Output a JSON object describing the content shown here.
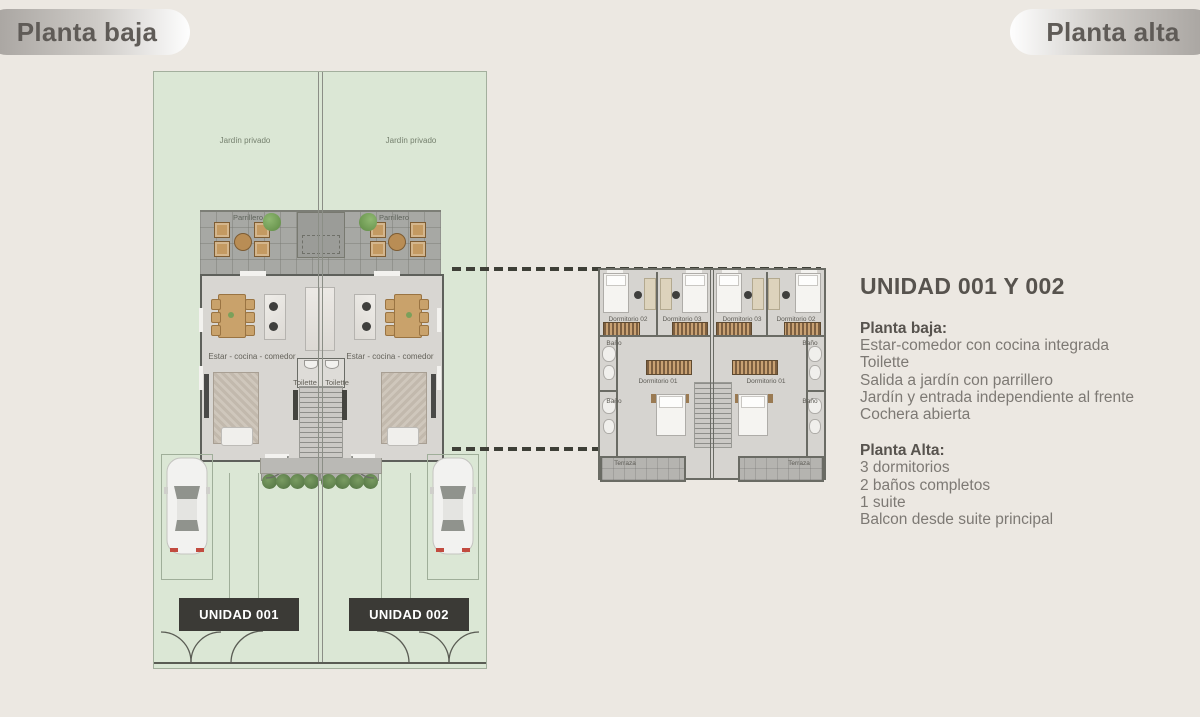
{
  "header": {
    "left_pill": "Planta baja",
    "right_pill": "Planta alta"
  },
  "ground_plan": {
    "garden_left_label": "Jardín privado",
    "garden_right_label": "Jardín privado",
    "parrillero_left_label": "Parrillero",
    "parrillero_right_label": "Parrillero",
    "living_left_label": "Estar - cocina - comedor",
    "living_right_label": "Estar - cocina - comedor",
    "toilette_left_label": "Toilette",
    "toilette_right_label": "Toilette",
    "unit_left_badge": "UNIDAD 001",
    "unit_right_badge": "UNIDAD 002"
  },
  "upper_plan": {
    "left_unit": {
      "bedroom2": "Dormitorio 02",
      "bedroom3": "Dormitorio 03",
      "bath_top": "Baño",
      "bedroom1": "Dormitorio 01",
      "bath_bottom": "Baño",
      "terrace": "Terraza"
    },
    "right_unit": {
      "bedroom3": "Dormitorio 03",
      "bedroom2": "Dormitorio 02",
      "bath_top": "Baño",
      "bedroom1": "Dormitorio 01",
      "bath_bottom": "Baño",
      "terrace": "Terraza"
    }
  },
  "info_panel": {
    "title": "UNIDAD 001 Y 002",
    "ground_heading": "Planta baja:",
    "ground_items": [
      "Estar-comedor con cocina integrada",
      "Toilette",
      "Salida a jardín con parrillero",
      "Jardín y entrada independiente al frente",
      "Cochera abierta"
    ],
    "upper_heading": "Planta Alta:",
    "upper_items": [
      "3 dormitorios",
      "2 baños completos",
      "1 suite",
      "Balcon desde suite principal"
    ]
  },
  "colors": {
    "page_bg": "#ece8e2",
    "garden_green": "#dbe7d5",
    "patio_gray": "#a7a8a4",
    "interior_gray": "#d8d6d2",
    "wall_dark": "#5e605b",
    "badge_dark": "#3b3a36",
    "text_heading": "#57534e",
    "text_body": "#7d7974"
  }
}
